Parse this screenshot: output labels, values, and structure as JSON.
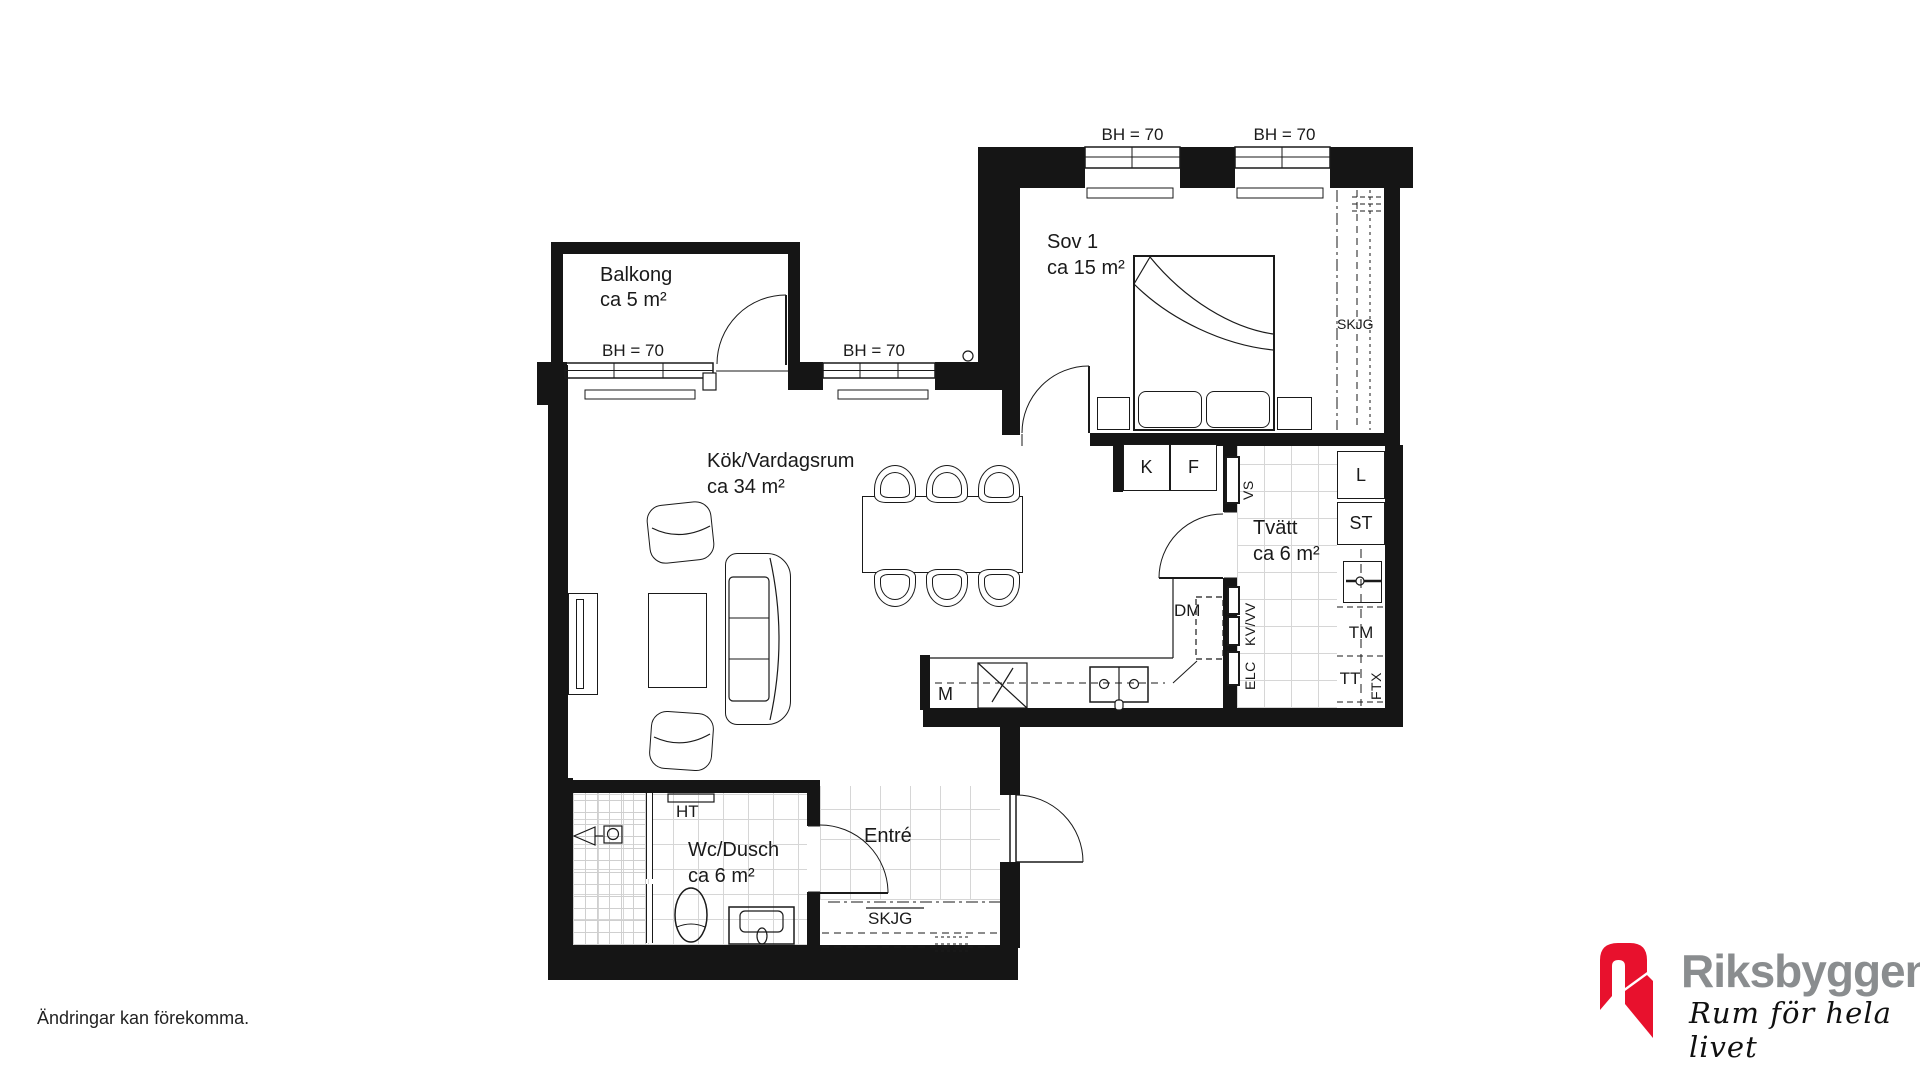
{
  "plan": {
    "rooms": {
      "balkong": {
        "name": "Balkong",
        "area": "ca 5 m²"
      },
      "sov1": {
        "name": "Sov 1",
        "area": "ca 15 m²"
      },
      "kok": {
        "name": "Kök/Vardagsrum",
        "area": "ca 34 m²"
      },
      "tvatt": {
        "name": "Tvätt",
        "area": "ca 6 m²"
      },
      "wc": {
        "name": "Wc/Dusch",
        "area": "ca 6 m²"
      },
      "entre": {
        "name": "Entré"
      }
    },
    "window_height_label": "BH = 70",
    "fixtures": {
      "fridge": "K",
      "freezer": "F",
      "water_shaft": "VS",
      "linen_cabinet": "L",
      "cleaning_cabinet": "ST",
      "dishwasher": "DM",
      "water_pipes": "KV/VV",
      "washing_machine": "TM",
      "electrical": "ELC",
      "dryer": "TT",
      "ventilation": "FTX",
      "micro": "M",
      "towel_rail": "HT",
      "sliding_wardrobe": "SKJG"
    }
  },
  "footer": {
    "disclaimer": "Ändringar kan förekomma."
  },
  "logo": {
    "brand": "Riksbyggen",
    "tagline": "Rum för hela livet",
    "brand_color": "#8a8d8f",
    "mark_color": "#e8112d"
  }
}
